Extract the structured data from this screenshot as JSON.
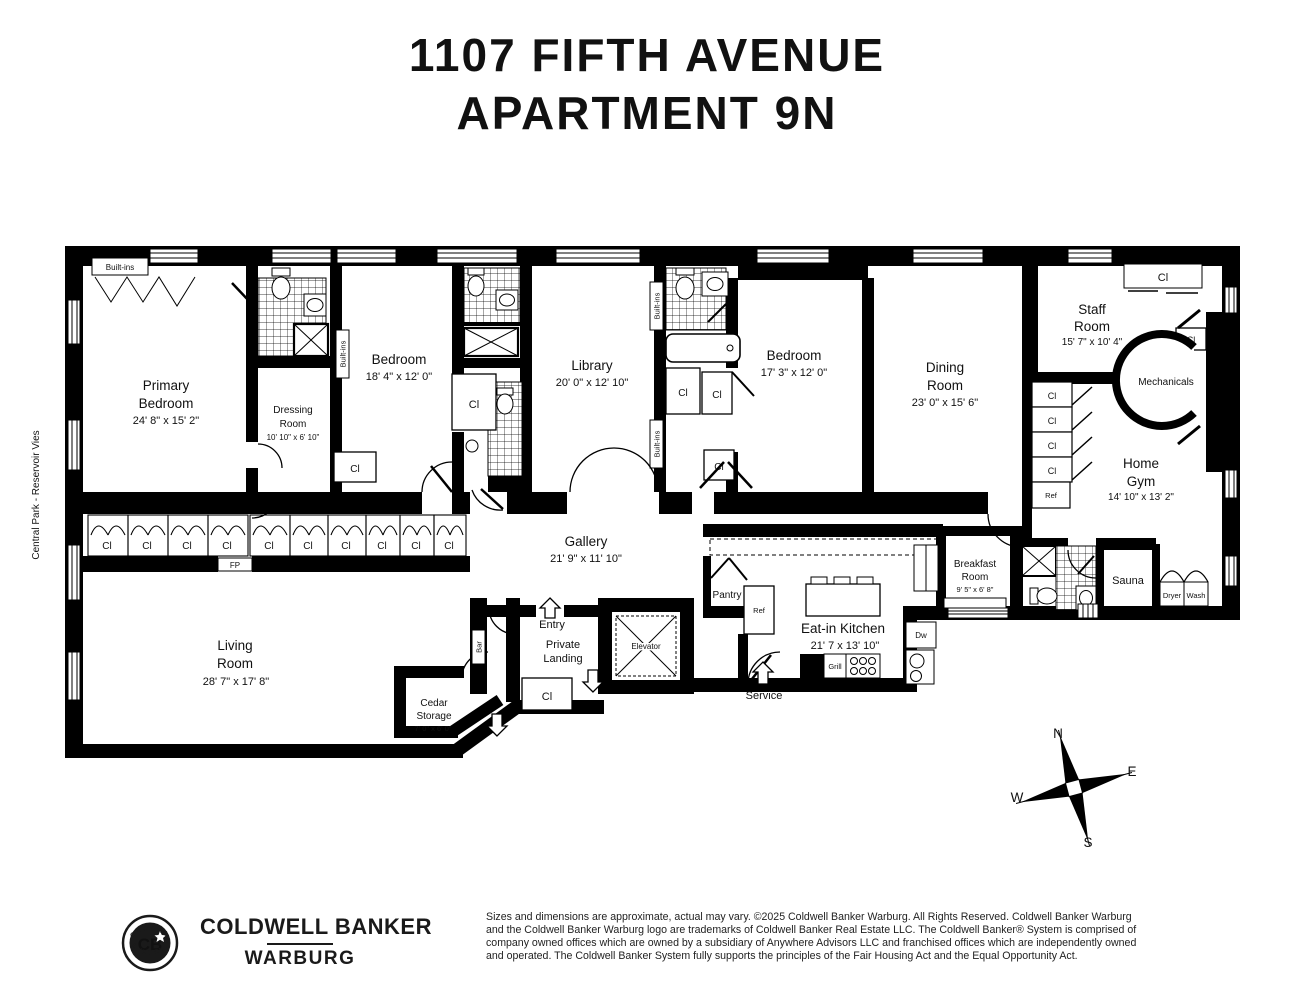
{
  "title": {
    "line1": "1107 FIFTH AVENUE",
    "line2": "APARTMENT 9N"
  },
  "side_label": "Central Park - Reservoir Vies",
  "rooms": {
    "primary_bedroom": {
      "name1": "Primary",
      "name2": "Bedroom",
      "dims": "24' 8\" x 15' 2\""
    },
    "dressing_room": {
      "name1": "Dressing",
      "name2": "Room",
      "dims": "10' 10\" x 6' 10\""
    },
    "bedroom1": {
      "name": "Bedroom",
      "dims": "18' 4\" x 12' 0\""
    },
    "library": {
      "name": "Library",
      "dims": "20' 0\" x 12' 10\""
    },
    "bedroom2": {
      "name": "Bedroom",
      "dims": "17' 3\" x 12' 0\""
    },
    "dining_room": {
      "name1": "Dining",
      "name2": "Room",
      "dims": "23' 0\" x 15' 6\""
    },
    "staff_room": {
      "name1": "Staff",
      "name2": "Room",
      "dims": "15' 7\" x 10' 4\""
    },
    "mechanicals": {
      "name": "Mechanicals"
    },
    "home_gym": {
      "name1": "Home",
      "name2": "Gym",
      "dims": "14' 10\" x 13' 2\""
    },
    "gallery": {
      "name": "Gallery",
      "dims": "21' 9\" x 11' 10\""
    },
    "living_room": {
      "name1": "Living",
      "name2": "Room",
      "dims": "28' 7\" x 17' 8\""
    },
    "cedar_storage": {
      "name1": "Cedar",
      "name2": "Storage",
      "dims": "7' 0\" x 6' 0\""
    },
    "entry": {
      "name": "Entry"
    },
    "private_landing": {
      "name1": "Private",
      "name2": "Landing"
    },
    "elevator": {
      "name": "Elevator"
    },
    "pantry": {
      "name": "Pantry"
    },
    "service": {
      "name": "Service"
    },
    "eat_in_kitchen": {
      "name": "Eat-in Kitchen",
      "dims": "21' 7 x 13' 10\""
    },
    "breakfast_room": {
      "name1": "Breakfast",
      "name2": "Room",
      "dims": "9' 5\" x 6' 8\""
    },
    "sauna": {
      "name": "Sauna"
    }
  },
  "labels": {
    "closet": "Cl",
    "built_ins": "Built-ins",
    "fireplace": "FP",
    "bar": "Bar",
    "ref": "Ref",
    "dw": "Dw",
    "grill": "Grill",
    "dryer": "Dryer",
    "wash": "Wash"
  },
  "compass": {
    "n": "N",
    "e": "E",
    "s": "S",
    "w": "W"
  },
  "logo": {
    "arc_top": "GLOBAL",
    "arc_bottom": "LUXURY.",
    "monogram": "CB",
    "brand_line1": "COLDWELL BANKER",
    "brand_line2": "WARBURG"
  },
  "disclaimer": "Sizes and dimensions are approximate, actual may vary.  ©2025 Coldwell Banker Warburg. All Rights Reserved. Coldwell Banker Warburg and the Coldwell Banker Warburg logo are trademarks of Coldwell Banker Real Estate LLC. The Coldwell Banker® System is comprised of company owned offices which are owned by a subsidiary of Anywhere Advisors LLC and franchised offices which are independently owned and operated. The Coldwell Banker System fully supports the principles of the Fair Housing Act and the Equal Opportunity Act."
}
